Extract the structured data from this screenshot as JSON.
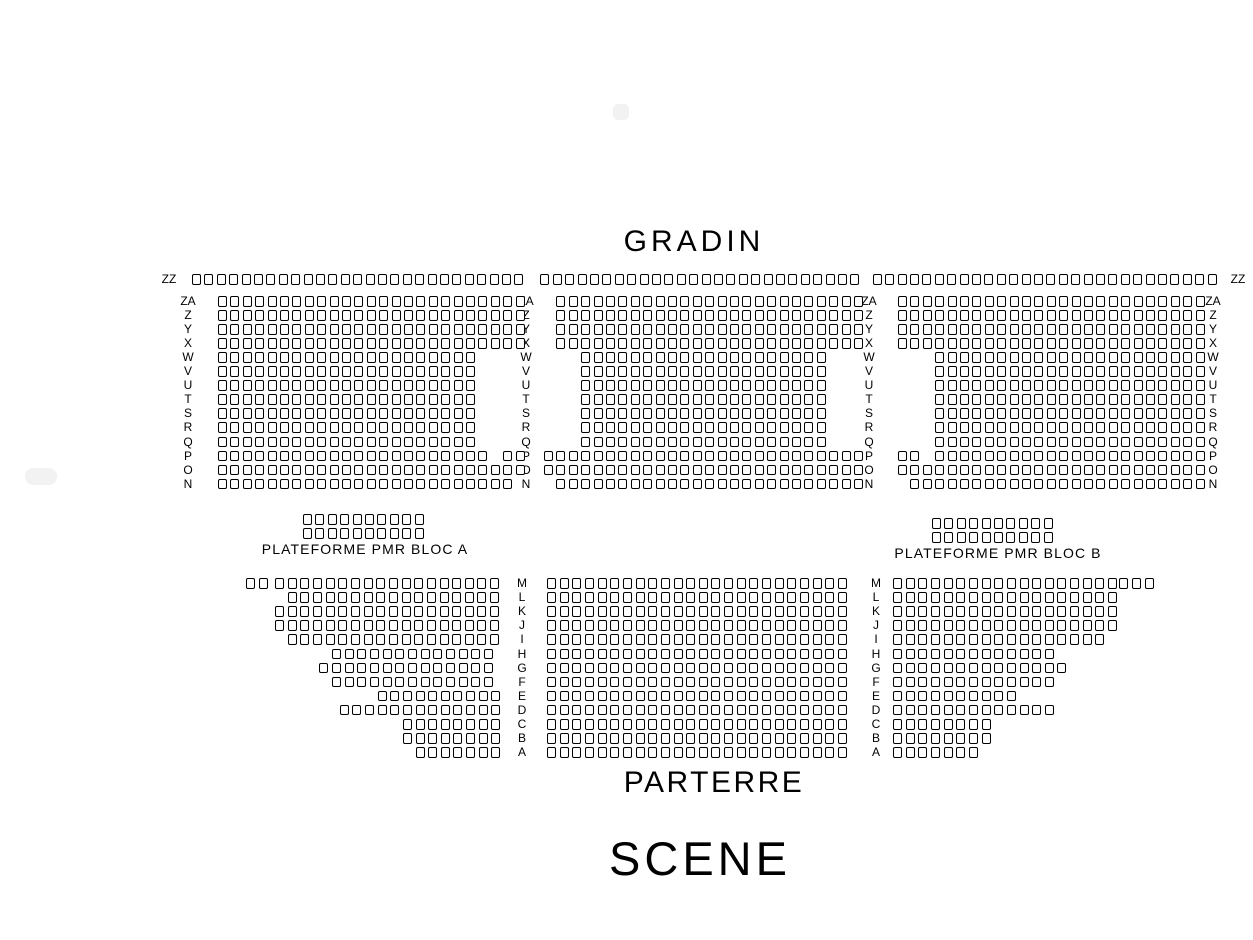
{
  "titles": {
    "gradin": "GRADIN",
    "parterre": "PARTERRE",
    "scene": "SCENE"
  },
  "pmr": {
    "bloc_a_label": "PLATEFORME PMR BLOC A",
    "bloc_b_label": "PLATEFORME PMR BLOC B"
  },
  "colors": {
    "seat_outline": "#000000",
    "text": "#000000",
    "background": "#ffffff",
    "artifact": "#f2f2f2"
  },
  "seatmap": {
    "blocks": [
      {
        "name": "gradin-row-zz",
        "x": 192,
        "y": 274,
        "col_pitch": 12.4,
        "row_pitch": 14,
        "rows": [
          {
            "label": "ZZ",
            "segs": [
              [
                0,
                27
              ],
              [
                28.1,
                26
              ],
              [
                54.9,
                28
              ]
            ]
          }
        ]
      },
      {
        "name": "gradin-block-left",
        "x": 218,
        "y": 296,
        "col_pitch": 12.4,
        "row_pitch": 14.05,
        "rows": [
          {
            "label": "ZA",
            "segs": [
              [
                0,
                25
              ]
            ]
          },
          {
            "label": "Z",
            "segs": [
              [
                0,
                25
              ]
            ]
          },
          {
            "label": "Y",
            "segs": [
              [
                0,
                25
              ]
            ]
          },
          {
            "label": "X",
            "segs": [
              [
                0,
                25
              ]
            ]
          },
          {
            "label": "W",
            "segs": [
              [
                0,
                21
              ]
            ]
          },
          {
            "label": "V",
            "segs": [
              [
                0,
                21
              ]
            ]
          },
          {
            "label": "U",
            "segs": [
              [
                0,
                21
              ]
            ]
          },
          {
            "label": "T",
            "segs": [
              [
                0,
                21
              ]
            ]
          },
          {
            "label": "S",
            "segs": [
              [
                0,
                21
              ]
            ]
          },
          {
            "label": "R",
            "segs": [
              [
                0,
                21
              ]
            ]
          },
          {
            "label": "Q",
            "segs": [
              [
                0,
                21
              ]
            ]
          },
          {
            "label": "P",
            "segs": [
              [
                0,
                22
              ],
              [
                23,
                2
              ]
            ]
          },
          {
            "label": "O",
            "segs": [
              [
                0,
                25
              ]
            ]
          },
          {
            "label": "N",
            "segs": [
              [
                0,
                24
              ]
            ]
          }
        ]
      },
      {
        "name": "gradin-block-center",
        "x": 544,
        "y": 296,
        "col_pitch": 12.4,
        "row_pitch": 14.05,
        "rows": [
          {
            "label": "ZA",
            "segs": [
              [
                1,
                25
              ]
            ]
          },
          {
            "label": "Z",
            "segs": [
              [
                1,
                25
              ]
            ]
          },
          {
            "label": "Y",
            "segs": [
              [
                1,
                25
              ]
            ]
          },
          {
            "label": "X",
            "segs": [
              [
                1,
                25
              ]
            ]
          },
          {
            "label": "W",
            "segs": [
              [
                3,
                20
              ]
            ]
          },
          {
            "label": "V",
            "segs": [
              [
                3,
                20
              ]
            ]
          },
          {
            "label": "U",
            "segs": [
              [
                3,
                20
              ]
            ]
          },
          {
            "label": "T",
            "segs": [
              [
                3,
                20
              ]
            ]
          },
          {
            "label": "S",
            "segs": [
              [
                3,
                20
              ]
            ]
          },
          {
            "label": "R",
            "segs": [
              [
                3,
                20
              ]
            ]
          },
          {
            "label": "Q",
            "segs": [
              [
                3,
                20
              ]
            ]
          },
          {
            "label": "P",
            "segs": [
              [
                0,
                26
              ]
            ]
          },
          {
            "label": "O",
            "segs": [
              [
                0,
                26
              ]
            ]
          },
          {
            "label": "N",
            "segs": [
              [
                1,
                25
              ]
            ]
          }
        ]
      },
      {
        "name": "gradin-block-right",
        "x": 898,
        "y": 296,
        "col_pitch": 12.4,
        "row_pitch": 14.05,
        "rows": [
          {
            "label": "ZA",
            "segs": [
              [
                0,
                25
              ]
            ]
          },
          {
            "label": "Z",
            "segs": [
              [
                0,
                25
              ]
            ]
          },
          {
            "label": "Y",
            "segs": [
              [
                0,
                25
              ]
            ]
          },
          {
            "label": "X",
            "segs": [
              [
                0,
                25
              ]
            ]
          },
          {
            "label": "W",
            "segs": [
              [
                3,
                22
              ]
            ]
          },
          {
            "label": "V",
            "segs": [
              [
                3,
                22
              ]
            ]
          },
          {
            "label": "U",
            "segs": [
              [
                3,
                22
              ]
            ]
          },
          {
            "label": "T",
            "segs": [
              [
                3,
                22
              ]
            ]
          },
          {
            "label": "S",
            "segs": [
              [
                3,
                22
              ]
            ]
          },
          {
            "label": "R",
            "segs": [
              [
                3,
                22
              ]
            ]
          },
          {
            "label": "Q",
            "segs": [
              [
                3,
                22
              ]
            ]
          },
          {
            "label": "P",
            "segs": [
              [
                0,
                2
              ],
              [
                3,
                22
              ]
            ]
          },
          {
            "label": "O",
            "segs": [
              [
                0,
                25
              ]
            ]
          },
          {
            "label": "N",
            "segs": [
              [
                1,
                24
              ]
            ]
          }
        ]
      },
      {
        "name": "pmr-platform-bloc-a",
        "x": 303,
        "y": 514,
        "col_pitch": 12.4,
        "row_pitch": 14,
        "rows": [
          {
            "label": "",
            "segs": [
              [
                0,
                10
              ]
            ]
          },
          {
            "label": "",
            "segs": [
              [
                0,
                10
              ]
            ]
          }
        ]
      },
      {
        "name": "pmr-platform-bloc-b",
        "x": 932,
        "y": 518,
        "col_pitch": 12.4,
        "row_pitch": 14,
        "rows": [
          {
            "label": "",
            "segs": [
              [
                0,
                10
              ]
            ]
          },
          {
            "label": "",
            "segs": [
              [
                0,
                10
              ]
            ]
          }
        ]
      },
      {
        "name": "parterre-block-left",
        "x": 246,
        "y": 578,
        "col_pitch": 12.65,
        "row_pitch": 14.1,
        "rows": [
          {
            "label": "M",
            "segs": [
              [
                0,
                2
              ],
              [
                2.3,
                18
              ]
            ]
          },
          {
            "label": "L",
            "segs": [
              [
                3.3,
                17
              ]
            ]
          },
          {
            "label": "K",
            "segs": [
              [
                2.3,
                18
              ]
            ]
          },
          {
            "label": "J",
            "segs": [
              [
                2.3,
                18
              ]
            ]
          },
          {
            "label": "I",
            "segs": [
              [
                3.3,
                17
              ]
            ]
          },
          {
            "label": "H",
            "segs": [
              [
                6.8,
                13
              ]
            ]
          },
          {
            "label": "G",
            "segs": [
              [
                5.8,
                14
              ]
            ]
          },
          {
            "label": "F",
            "segs": [
              [
                6.8,
                13
              ]
            ]
          },
          {
            "label": "E",
            "segs": [
              [
                10.4,
                10
              ]
            ]
          },
          {
            "label": "D",
            "segs": [
              [
                7.4,
                13
              ]
            ]
          },
          {
            "label": "C",
            "segs": [
              [
                12.4,
                8
              ]
            ]
          },
          {
            "label": "B",
            "segs": [
              [
                12.4,
                8
              ]
            ]
          },
          {
            "label": "A",
            "segs": [
              [
                13.4,
                7
              ]
            ]
          }
        ]
      },
      {
        "name": "parterre-block-center",
        "x": 547,
        "y": 578,
        "col_pitch": 12.65,
        "row_pitch": 14.1,
        "rows": [
          {
            "label": "M",
            "segs": [
              [
                0,
                24
              ]
            ]
          },
          {
            "label": "L",
            "segs": [
              [
                0,
                24
              ]
            ]
          },
          {
            "label": "K",
            "segs": [
              [
                0,
                24
              ]
            ]
          },
          {
            "label": "J",
            "segs": [
              [
                0,
                24
              ]
            ]
          },
          {
            "label": "I",
            "segs": [
              [
                0,
                24
              ]
            ]
          },
          {
            "label": "H",
            "segs": [
              [
                0,
                24
              ]
            ]
          },
          {
            "label": "G",
            "segs": [
              [
                0,
                24
              ]
            ]
          },
          {
            "label": "F",
            "segs": [
              [
                0,
                24
              ]
            ]
          },
          {
            "label": "E",
            "segs": [
              [
                0,
                24
              ]
            ]
          },
          {
            "label": "D",
            "segs": [
              [
                0,
                24
              ]
            ]
          },
          {
            "label": "C",
            "segs": [
              [
                0,
                24
              ]
            ]
          },
          {
            "label": "B",
            "segs": [
              [
                0,
                24
              ]
            ]
          },
          {
            "label": "A",
            "segs": [
              [
                0,
                24
              ]
            ]
          }
        ]
      },
      {
        "name": "parterre-block-right",
        "x": 893,
        "y": 578,
        "col_pitch": 12.65,
        "row_pitch": 14.1,
        "rows": [
          {
            "label": "M",
            "segs": [
              [
                0,
                18
              ],
              [
                17.9,
                3
              ]
            ]
          },
          {
            "label": "L",
            "segs": [
              [
                0,
                18
              ]
            ]
          },
          {
            "label": "K",
            "segs": [
              [
                0,
                18
              ]
            ]
          },
          {
            "label": "J",
            "segs": [
              [
                0,
                18
              ]
            ]
          },
          {
            "label": "I",
            "segs": [
              [
                0,
                17
              ]
            ]
          },
          {
            "label": "H",
            "segs": [
              [
                0,
                13
              ]
            ]
          },
          {
            "label": "G",
            "segs": [
              [
                0,
                14
              ]
            ]
          },
          {
            "label": "F",
            "segs": [
              [
                0,
                13
              ]
            ]
          },
          {
            "label": "E",
            "segs": [
              [
                0,
                10
              ]
            ]
          },
          {
            "label": "D",
            "segs": [
              [
                0,
                13
              ]
            ]
          },
          {
            "label": "C",
            "segs": [
              [
                0,
                8
              ]
            ]
          },
          {
            "label": "B",
            "segs": [
              [
                0,
                8
              ]
            ]
          },
          {
            "label": "A",
            "segs": [
              [
                0,
                7
              ]
            ]
          }
        ]
      }
    ],
    "label_columns": [
      {
        "name": "zz-row-label-left",
        "x": 169,
        "y": 274,
        "pitch": 14,
        "labels": [
          "ZZ"
        ]
      },
      {
        "name": "zz-row-label-right",
        "x": 1238,
        "y": 274,
        "pitch": 14,
        "labels": [
          "ZZ"
        ]
      },
      {
        "name": "gradin-row-labels-left",
        "x": 188,
        "y": 296,
        "pitch": 14.05,
        "labels": [
          "ZA",
          "Z",
          "Y",
          "X",
          "W",
          "V",
          "U",
          "T",
          "S",
          "R",
          "Q",
          "P",
          "O",
          "N"
        ]
      },
      {
        "name": "gradin-row-labels-mid-left",
        "x": 526,
        "y": 296,
        "pitch": 14.05,
        "labels": [
          "ZA",
          "Z",
          "Y",
          "X",
          "W",
          "V",
          "U",
          "T",
          "S",
          "R",
          "Q",
          "P",
          "O",
          "N"
        ]
      },
      {
        "name": "gradin-row-labels-mid-right",
        "x": 869,
        "y": 296,
        "pitch": 14.05,
        "labels": [
          "ZA",
          "Z",
          "Y",
          "X",
          "W",
          "V",
          "U",
          "T",
          "S",
          "R",
          "Q",
          "P",
          "O",
          "N"
        ]
      },
      {
        "name": "gradin-row-labels-right",
        "x": 1213,
        "y": 296,
        "pitch": 14.05,
        "labels": [
          "ZA",
          "Z",
          "Y",
          "X",
          "W",
          "V",
          "U",
          "T",
          "S",
          "R",
          "Q",
          "P",
          "O",
          "N"
        ]
      },
      {
        "name": "parterre-row-labels-left",
        "x": 522,
        "y": 578,
        "pitch": 14.1,
        "labels": [
          "M",
          "L",
          "K",
          "J",
          "I",
          "H",
          "G",
          "F",
          "E",
          "D",
          "C",
          "B",
          "A"
        ]
      },
      {
        "name": "parterre-row-labels-right",
        "x": 876,
        "y": 578,
        "pitch": 14.1,
        "labels": [
          "M",
          "L",
          "K",
          "J",
          "I",
          "H",
          "G",
          "F",
          "E",
          "D",
          "C",
          "B",
          "A"
        ]
      }
    ],
    "artifacts": [
      {
        "name": "faded-control-top",
        "x": 613,
        "y": 104,
        "w": 16,
        "h": 16,
        "r": 5
      },
      {
        "name": "faded-control-left",
        "x": 25,
        "y": 468,
        "w": 32,
        "h": 17,
        "r": 8
      }
    ]
  }
}
